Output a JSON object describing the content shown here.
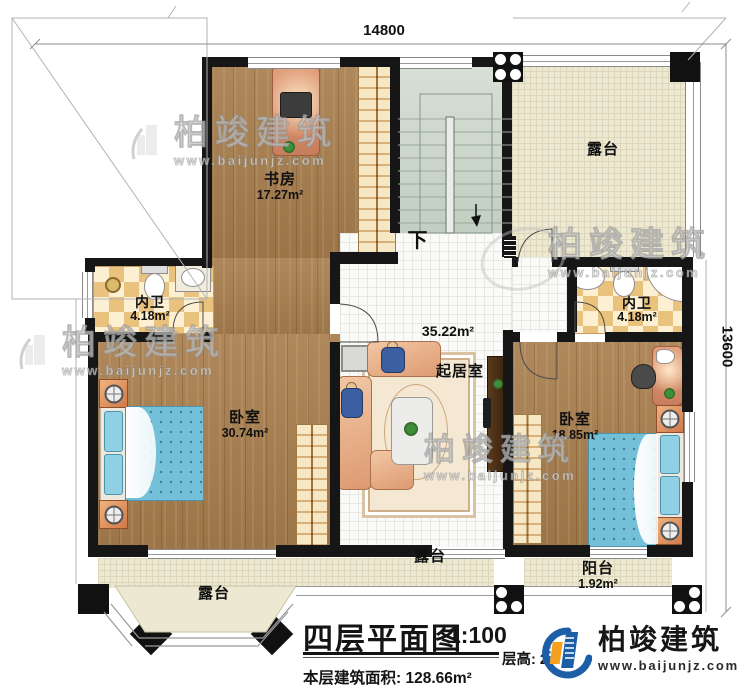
{
  "dimensions": {
    "top": "14800",
    "right": "13600"
  },
  "rooms": {
    "study": {
      "name": "书房",
      "area": "17.27m²"
    },
    "bath_left": {
      "name": "内卫",
      "area": "4.18m²"
    },
    "bath_right": {
      "name": "内卫",
      "area": "4.18m²"
    },
    "bedroom_left": {
      "name": "卧室",
      "area": "30.74m²"
    },
    "bedroom_right": {
      "name": "卧室",
      "area": "18.85m²"
    },
    "living": {
      "name": "起居室",
      "area": "35.22m²"
    },
    "terrace_top": {
      "name": "露台"
    },
    "terrace_mid": {
      "name": "露台"
    },
    "terrace_bay": {
      "name": "露台"
    },
    "balcony": {
      "name": "阳台",
      "area": "1.92m²"
    },
    "stairs": {
      "down": "下"
    }
  },
  "title_block": {
    "title": "四层平面图",
    "scale": "1:100",
    "area_label": "本层建筑面积:",
    "area_value": "128.66m²",
    "floor_height_label": "层高:",
    "floor_height_value": "2"
  },
  "brand": {
    "name": "柏竣建筑",
    "url": "www.baijunjz.com"
  },
  "watermark": {
    "name": "柏竣建筑",
    "url": "www.baijunjz.com"
  },
  "colors": {
    "wall": "#161616",
    "wood": "#a87e4e",
    "terrace": "#ece8d1",
    "checker": "#e9c27d",
    "bed": "#74c0d8",
    "brand_blue": "#1d5fa7",
    "brand_orange": "#f5a11d"
  }
}
